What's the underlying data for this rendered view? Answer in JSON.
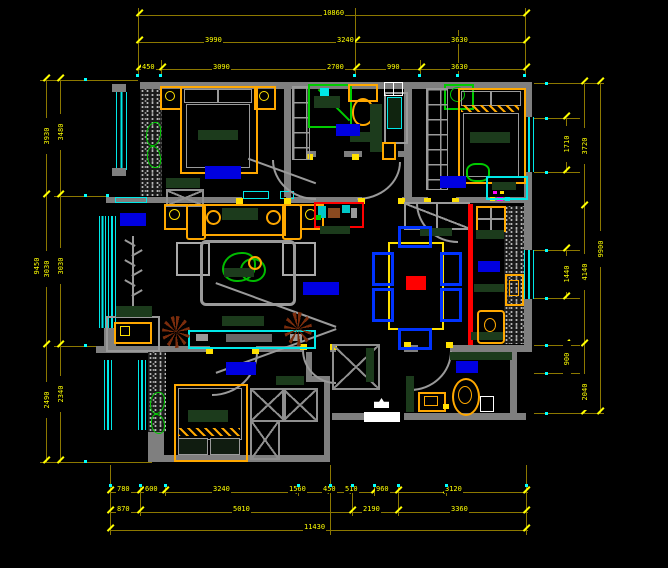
{
  "title": "apartment-floor-plan-cad",
  "canvas": {
    "background": "#000000",
    "width": 668,
    "height": 568
  },
  "colors": {
    "wall": "#7f7f7f",
    "dimension_line": "#8c7800",
    "dimension_text": "#ffff00",
    "window": "#00e8e8",
    "furniture_accent": "#ffa800",
    "counter_green": "#1c3b1c",
    "fixture_green": "#00cc00",
    "room_label": "#0000e0",
    "chair_blue": "#0033ff",
    "highlight_red": "#ff0000",
    "plant_brown": "#7a2c0c",
    "tick_cyan": "#00ffff"
  },
  "dims": {
    "top_row1": [
      "10860"
    ],
    "top_row2": [
      "3990",
      "3240",
      "3630"
    ],
    "top_row3": [
      "450",
      "3090",
      "2700",
      "990",
      "3630"
    ],
    "bottom_row1": [
      "780",
      "600",
      "3240",
      "1560",
      "450",
      "510",
      "960",
      "3120"
    ],
    "bottom_row2": [
      "870",
      "5010",
      "2190",
      "3360"
    ],
    "bottom_row3": [
      "11430"
    ],
    "left_outer": [
      "3930",
      "3030",
      "2490"
    ],
    "left_inner": [
      "3480",
      "3030",
      "2340"
    ],
    "left_overall": [
      "9450"
    ],
    "right_chain1": [
      "1710",
      "1440",
      "900"
    ],
    "right_chain2": [
      "3720",
      "4140",
      "2040"
    ],
    "right_overall": [
      "9900"
    ]
  },
  "rooms": [
    {
      "id": "bedroom-top-left",
      "furniture": [
        "double-bed",
        "nightstands",
        "wardrobe",
        "bench",
        "plant"
      ]
    },
    {
      "id": "bathroom-top",
      "furniture": [
        "shower",
        "toilet",
        "washbasin",
        "cabinet"
      ]
    },
    {
      "id": "bedroom-top-right",
      "furniture": [
        "double-bed",
        "wardrobe",
        "desk",
        "chair",
        "plant-box"
      ]
    },
    {
      "id": "living-room",
      "furniture": [
        "sofa-set",
        "coffee-table",
        "tv-cabinet",
        "plants",
        "coat-rack"
      ]
    },
    {
      "id": "dining-room",
      "furniture": [
        "dining-table",
        "six-chairs",
        "sideboard",
        "aquarium-cabinet"
      ]
    },
    {
      "id": "kitchen",
      "furniture": [
        "stove",
        "sink",
        "counters",
        "fridge"
      ]
    },
    {
      "id": "bedroom-bottom-left",
      "furniture": [
        "double-bed",
        "wardrobe",
        "shelf"
      ]
    },
    {
      "id": "bathroom-bottom",
      "furniture": [
        "toilet",
        "washbasin",
        "counter"
      ]
    },
    {
      "id": "hallway",
      "furniture": [
        "closet",
        "entry-marker"
      ]
    },
    {
      "id": "balcony",
      "furniture": [
        "washing-machine",
        "shelf",
        "windows"
      ]
    }
  ],
  "markers": {
    "entry_threshold": "white-bar",
    "entry_glyph": "white-arrow-icon",
    "door_hinge": "yellow-square",
    "red_partition": "highlighted-wall-line"
  }
}
